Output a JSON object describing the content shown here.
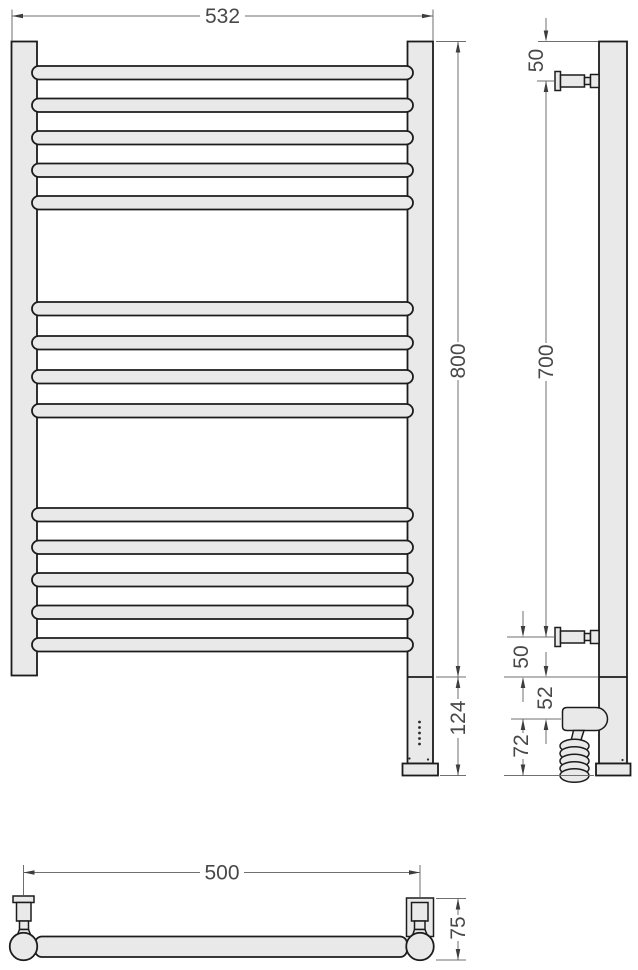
{
  "figure": {
    "kind": "technical-drawing",
    "subject": "heated towel rail, three orthographic views with dimensions",
    "rung_count": 14,
    "rung_groups": [
      5,
      4,
      5
    ]
  },
  "dims": {
    "front": {
      "width": "532",
      "height": "800",
      "bottom": "124"
    },
    "side": {
      "top_offset": "50",
      "span": "700",
      "bottom_offset": "50",
      "joint_to_heater": "52",
      "heater_to_base": "72"
    },
    "bottom": {
      "span": "500",
      "depth": "75"
    }
  },
  "colors": {
    "fill": "#e9e9e9",
    "outline": "#1c1c1c",
    "dimension_line": "#6f6f6f",
    "label": "#484848"
  }
}
